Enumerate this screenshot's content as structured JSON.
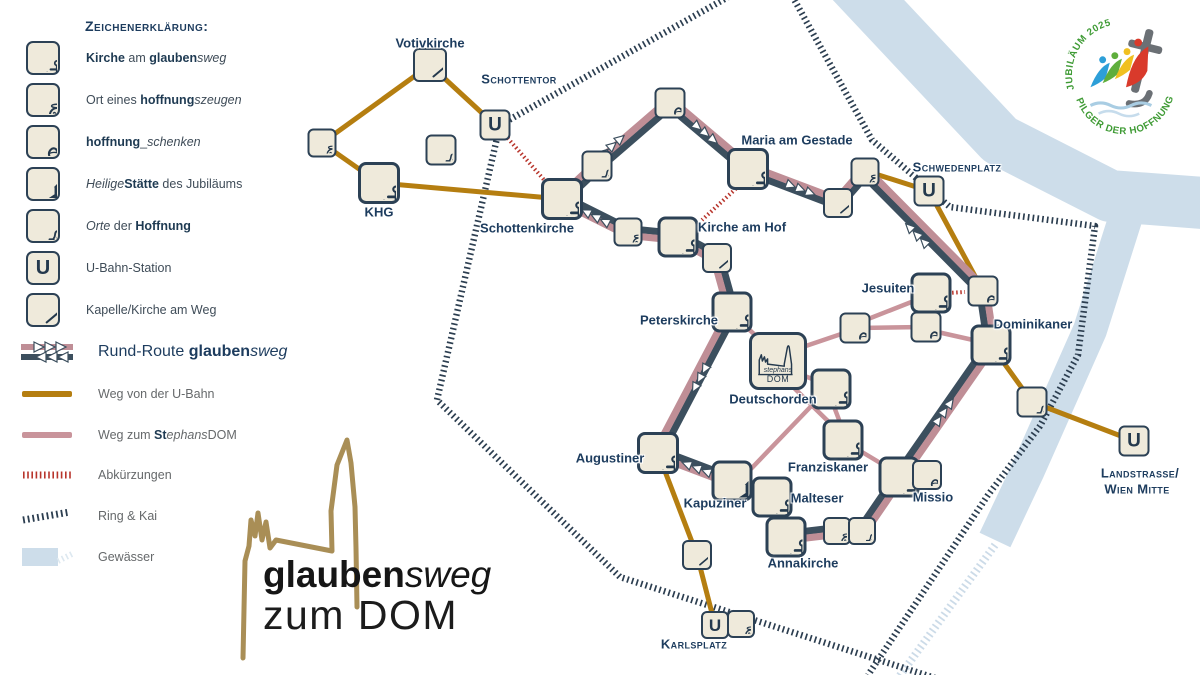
{
  "legend": {
    "title": "Zeichenerklärung:",
    "items": [
      {
        "icon": "kirche",
        "label": [
          [
            "Kirche",
            "b"
          ],
          [
            " am ",
            ""
          ],
          [
            "glauben",
            "b"
          ],
          [
            "sweg",
            "i"
          ]
        ]
      },
      {
        "icon": "zeuge",
        "label": [
          [
            "Ort eines ",
            ""
          ],
          [
            "hoffnung",
            "b"
          ],
          [
            "szeugen",
            "i"
          ]
        ]
      },
      {
        "icon": "herz",
        "label": [
          [
            "hoffnung",
            "b"
          ],
          [
            "_",
            ""
          ],
          [
            "schenken",
            "i"
          ]
        ]
      },
      {
        "icon": "staette",
        "label": [
          [
            "Heilige",
            "i"
          ],
          [
            "Stätte",
            "b"
          ],
          [
            " des Jubiläums",
            ""
          ]
        ]
      },
      {
        "icon": "hoffnung",
        "label": [
          [
            "Orte",
            "i"
          ],
          [
            " der ",
            ""
          ],
          [
            "Hoffnung",
            "b"
          ]
        ]
      },
      {
        "icon": "ubahn",
        "label": [
          [
            "U-Bahn-Station",
            ""
          ]
        ]
      },
      {
        "icon": "kapelle",
        "label": [
          [
            "Kapelle/Kirche  am Weg",
            ""
          ]
        ]
      }
    ],
    "lines": [
      {
        "swatch": "route",
        "big": true,
        "label": [
          [
            "Rund-Route ",
            ""
          ],
          [
            "glauben",
            "b"
          ],
          [
            "sweg",
            "i"
          ]
        ]
      },
      {
        "swatch": "gold",
        "big": false,
        "label": [
          [
            "Weg von der U-Bahn",
            ""
          ]
        ]
      },
      {
        "swatch": "pink",
        "big": false,
        "label": [
          [
            "Weg zum ",
            ""
          ],
          [
            "St",
            "b"
          ],
          [
            "ephans",
            "i"
          ],
          [
            "DOM",
            ""
          ]
        ]
      },
      {
        "swatch": "red",
        "big": false,
        "label": [
          [
            "Abkürzungen",
            ""
          ]
        ]
      },
      {
        "swatch": "ring",
        "big": false,
        "label": [
          [
            "Ring & Kai",
            ""
          ]
        ]
      },
      {
        "swatch": "water",
        "big": false,
        "label": [
          [
            "Gewässer",
            ""
          ]
        ]
      }
    ]
  },
  "brand": {
    "bold": "glauben",
    "italic": "sweg",
    "line2": "zum DOM"
  },
  "logo": {
    "top": "JUBILÄUM 2025",
    "bottom": "PILGER DER HOFFNUNG"
  },
  "map": {
    "u_glyph": "U",
    "dom_icon": {
      "line1": "stephans",
      "line2": "DOM"
    },
    "colors": {
      "route_dark": "#3c4f5e",
      "route_pink": "#bf8e96",
      "ubahn_gold": "#b57e10",
      "dom_pink": "#c9949b",
      "shortcut_red": "#b8352c",
      "ring_navy": "#2c3e50",
      "water": "#cdddea",
      "water_hatch": "#ccdbe8",
      "icon_bg": "#efeadb",
      "icon_border": "#2c4155",
      "label": "#1d3c5e",
      "arrow_fill": "#ffffff"
    },
    "nodes": [
      {
        "id": "votivkirche",
        "type": "kapelle",
        "x": 430,
        "y": 65,
        "s": 34
      },
      {
        "id": "schottentor-u",
        "type": "ubahn",
        "x": 495,
        "y": 125,
        "s": 31
      },
      {
        "id": "zeuge-west",
        "type": "zeuge",
        "x": 322,
        "y": 143,
        "s": 29
      },
      {
        "id": "hoffnung-votiv",
        "type": "hoffnung",
        "x": 441,
        "y": 150,
        "s": 31
      },
      {
        "id": "khg",
        "type": "kirche",
        "x": 379,
        "y": 183,
        "s": 42
      },
      {
        "id": "schottenkirche",
        "type": "kirche",
        "x": 562,
        "y": 199,
        "s": 42
      },
      {
        "id": "herz-nord",
        "type": "herz",
        "x": 670,
        "y": 103,
        "s": 31
      },
      {
        "id": "hoffnung-nord",
        "type": "hoffnung",
        "x": 597,
        "y": 166,
        "s": 31
      },
      {
        "id": "zeuge-hof",
        "type": "zeuge",
        "x": 628,
        "y": 232,
        "s": 29
      },
      {
        "id": "kirche-am-hof",
        "type": "kirche",
        "x": 678,
        "y": 237,
        "s": 41
      },
      {
        "id": "kapelle-hof",
        "type": "kapelle",
        "x": 717,
        "y": 258,
        "s": 30
      },
      {
        "id": "maria-am-gestade",
        "type": "kirche",
        "x": 748,
        "y": 169,
        "s": 42
      },
      {
        "id": "kapelle-ost",
        "type": "kapelle",
        "x": 838,
        "y": 203,
        "s": 30
      },
      {
        "id": "zeuge-schweden",
        "type": "zeuge",
        "x": 865,
        "y": 172,
        "s": 29
      },
      {
        "id": "schwedenplatz-u",
        "type": "ubahn",
        "x": 929,
        "y": 191,
        "s": 31
      },
      {
        "id": "jesuiten",
        "type": "kirche",
        "x": 931,
        "y": 293,
        "s": 41
      },
      {
        "id": "herz-ost",
        "type": "herz",
        "x": 983,
        "y": 291,
        "s": 31
      },
      {
        "id": "herz-jesuiten",
        "type": "herz",
        "x": 926,
        "y": 327,
        "s": 31
      },
      {
        "id": "herz-mitte",
        "type": "herz",
        "x": 855,
        "y": 328,
        "s": 31
      },
      {
        "id": "dominikaner",
        "type": "kirche",
        "x": 991,
        "y": 345,
        "s": 41
      },
      {
        "id": "hoffnung-land",
        "type": "hoffnung",
        "x": 1032,
        "y": 402,
        "s": 31
      },
      {
        "id": "landstrasse-u",
        "type": "ubahn",
        "x": 1134,
        "y": 441,
        "s": 31
      },
      {
        "id": "peterskirche",
        "type": "kirche",
        "x": 732,
        "y": 312,
        "s": 41
      },
      {
        "id": "dom",
        "type": "dom",
        "x": 778,
        "y": 361,
        "s": 58
      },
      {
        "id": "deutschorden",
        "type": "kirche",
        "x": 831,
        "y": 389,
        "s": 41
      },
      {
        "id": "franziskaner",
        "type": "kirche",
        "x": 843,
        "y": 440,
        "s": 41
      },
      {
        "id": "augustiner",
        "type": "kirche",
        "x": 658,
        "y": 453,
        "s": 42
      },
      {
        "id": "kapuziner",
        "type": "staette",
        "x": 732,
        "y": 481,
        "s": 41
      },
      {
        "id": "malteser",
        "type": "kirche",
        "x": 772,
        "y": 497,
        "s": 41
      },
      {
        "id": "missio",
        "type": "kirche",
        "x": 899,
        "y": 477,
        "s": 41
      },
      {
        "id": "herz-missio",
        "type": "herz",
        "x": 927,
        "y": 475,
        "s": 30
      },
      {
        "id": "annakirche",
        "type": "kirche",
        "x": 786,
        "y": 537,
        "s": 41
      },
      {
        "id": "zeuge-anna",
        "type": "zeuge",
        "x": 837,
        "y": 531,
        "s": 28
      },
      {
        "id": "hoffnung-anna",
        "type": "hoffnung",
        "x": 862,
        "y": 531,
        "s": 28
      },
      {
        "id": "kapelle-sued",
        "type": "kapelle",
        "x": 697,
        "y": 555,
        "s": 30
      },
      {
        "id": "karlsplatz-u",
        "type": "ubahn",
        "x": 715,
        "y": 625,
        "s": 28
      },
      {
        "id": "zeuge-karls",
        "type": "zeuge",
        "x": 741,
        "y": 624,
        "s": 28
      }
    ],
    "labels": [
      {
        "t": "Votivkirche",
        "x": 430,
        "y": 43,
        "caps": false
      },
      {
        "t": "Schottentor",
        "x": 519,
        "y": 79,
        "caps": true
      },
      {
        "t": "KHG",
        "x": 379,
        "y": 212,
        "caps": false
      },
      {
        "t": "Schottenkirche",
        "x": 527,
        "y": 228,
        "caps": false
      },
      {
        "t": "Maria am Gestade",
        "x": 797,
        "y": 140,
        "caps": false
      },
      {
        "t": "Schwedenplatz",
        "x": 957,
        "y": 167,
        "caps": true
      },
      {
        "t": "Kirche am Hof",
        "x": 742,
        "y": 227,
        "caps": false
      },
      {
        "t": "Jesuiten",
        "x": 888,
        "y": 288,
        "caps": false
      },
      {
        "t": "Dominikaner",
        "x": 1033,
        "y": 324,
        "caps": false
      },
      {
        "t": "Peterskirche",
        "x": 679,
        "y": 320,
        "caps": false
      },
      {
        "t": "Deutschorden",
        "x": 773,
        "y": 399,
        "caps": false
      },
      {
        "t": "Franziskaner",
        "x": 828,
        "y": 467,
        "caps": false
      },
      {
        "t": "Augustiner",
        "x": 610,
        "y": 458,
        "caps": false
      },
      {
        "t": "Kapuziner",
        "x": 715,
        "y": 503,
        "caps": false
      },
      {
        "t": "Malteser",
        "x": 817,
        "y": 498,
        "caps": false
      },
      {
        "t": "Missio",
        "x": 933,
        "y": 497,
        "caps": false
      },
      {
        "t": "Annakirche",
        "x": 803,
        "y": 563,
        "caps": false
      },
      {
        "t": "Karlsplatz",
        "x": 694,
        "y": 644,
        "caps": true
      },
      {
        "t": "Landstrasse/",
        "x": 1140,
        "y": 473,
        "caps": true
      },
      {
        "t": "Wien Mitte",
        "x": 1137,
        "y": 489,
        "caps": true
      }
    ],
    "routes": {
      "loop": [
        [
          562,
          199
        ],
        [
          597,
          166
        ],
        [
          670,
          103
        ],
        [
          748,
          169
        ],
        [
          838,
          203
        ],
        [
          865,
          172
        ],
        [
          983,
          291
        ],
        [
          991,
          345
        ],
        [
          899,
          477
        ],
        [
          862,
          531
        ],
        [
          837,
          531
        ],
        [
          786,
          537
        ],
        [
          772,
          497
        ],
        [
          732,
          481
        ],
        [
          658,
          453
        ],
        [
          732,
          312
        ],
        [
          717,
          258
        ],
        [
          678,
          237
        ],
        [
          628,
          232
        ]
      ],
      "gold": [
        [
          [
            322,
            143
          ],
          [
            430,
            65
          ]
        ],
        [
          [
            430,
            65
          ],
          [
            495,
            125
          ]
        ],
        [
          [
            322,
            143
          ],
          [
            379,
            183
          ]
        ],
        [
          [
            379,
            183
          ],
          [
            562,
            199
          ]
        ],
        [
          [
            866,
            171
          ],
          [
            929,
            191
          ]
        ],
        [
          [
            929,
            191
          ],
          [
            983,
            291
          ]
        ],
        [
          [
            991,
            345
          ],
          [
            1032,
            402
          ],
          [
            1134,
            441
          ]
        ],
        [
          [
            658,
            453
          ],
          [
            697,
            555
          ],
          [
            715,
            625
          ]
        ]
      ],
      "pink": [
        [
          [
            775,
            354
          ],
          [
            738,
            319
          ]
        ],
        [
          [
            791,
            351
          ],
          [
            853,
            330
          ]
        ],
        [
          [
            858,
            328
          ],
          [
            924,
            327
          ]
        ],
        [
          [
            863,
            321
          ],
          [
            919,
            299
          ]
        ],
        [
          [
            933,
            331
          ],
          [
            982,
            342
          ]
        ],
        [
          [
            794,
            372
          ],
          [
            823,
            383
          ]
        ],
        [
          [
            833,
            404
          ],
          [
            841,
            425
          ]
        ],
        [
          [
            787,
            381
          ],
          [
            836,
            429
          ]
        ],
        [
          [
            819,
            398
          ],
          [
            748,
            472
          ]
        ],
        [
          [
            857,
            449
          ],
          [
            887,
            467
          ]
        ],
        [
          [
            931,
            300
          ],
          [
            927,
            316
          ]
        ]
      ],
      "shortcuts": [
        [
          [
            505,
            135
          ],
          [
            552,
            189
          ]
        ],
        [
          [
            742,
            183
          ],
          [
            702,
            220
          ]
        ],
        [
          [
            948,
            293
          ],
          [
            965,
            292
          ]
        ]
      ],
      "ring": [
        [
          [
            737,
            -8
          ],
          [
            500,
            125
          ],
          [
            437,
            400
          ],
          [
            620,
            577
          ],
          [
            935,
            678
          ]
        ],
        [
          [
            790,
            -8
          ],
          [
            872,
            140
          ],
          [
            950,
            207
          ],
          [
            1095,
            226
          ],
          [
            1078,
            355
          ],
          [
            1040,
            426
          ],
          [
            988,
            495
          ],
          [
            868,
            675
          ]
        ]
      ],
      "water": [
        {
          "p": [
            [
              845,
              -25
            ],
            [
              1000,
              140
            ],
            [
              1110,
              196
            ],
            [
              1230,
              205
            ]
          ],
          "w": 52
        },
        {
          "p": [
            [
              1128,
              210
            ],
            [
              1090,
              330
            ],
            [
              1028,
              470
            ],
            [
              995,
              540
            ]
          ],
          "w": 34
        }
      ],
      "water_hatch": [
        [
          [
            995,
            545
          ],
          [
            893,
            685
          ]
        ]
      ]
    },
    "arrows": [
      {
        "x": 612,
        "y": 146,
        "a": -41
      },
      {
        "x": 705,
        "y": 133,
        "a": 40
      },
      {
        "x": 800,
        "y": 189,
        "a": 21
      },
      {
        "x": 917,
        "y": 235,
        "a": -135
      },
      {
        "x": 944,
        "y": 412,
        "a": -55
      },
      {
        "x": 700,
        "y": 378,
        "a": 118
      },
      {
        "x": 697,
        "y": 468,
        "a": -159
      },
      {
        "x": 596,
        "y": 217,
        "a": -153
      }
    ]
  }
}
